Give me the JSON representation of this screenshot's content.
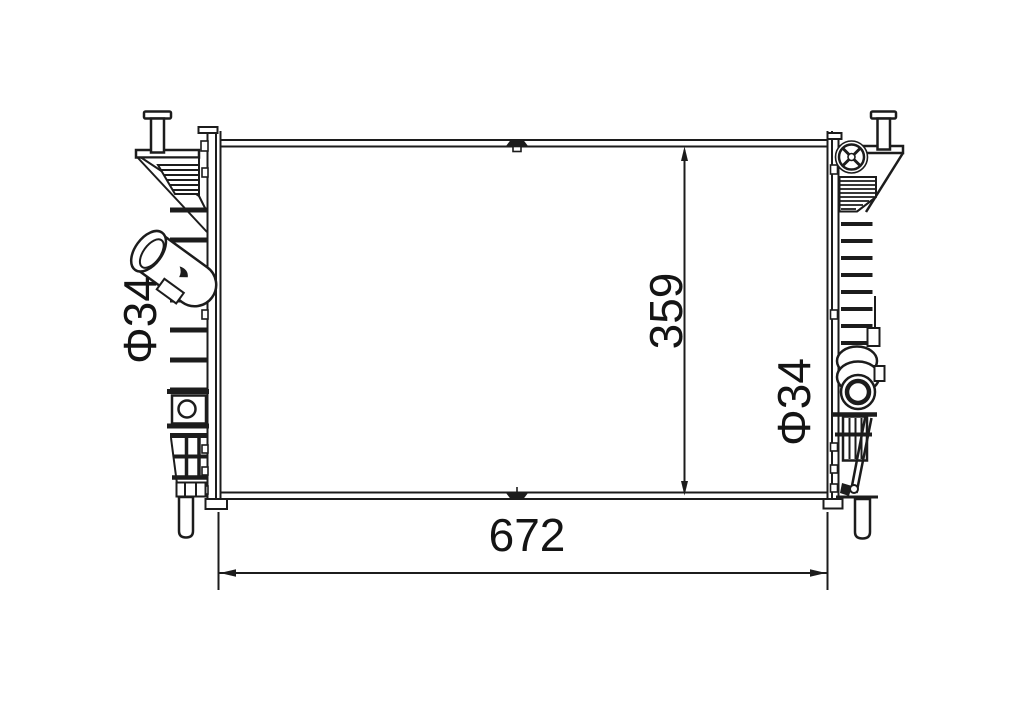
{
  "drawing": {
    "background_color": "#ffffff",
    "line_color": "#1c1c1c",
    "labels": {
      "width": "672",
      "height": "359",
      "inlet_diameter": "Φ34",
      "outlet_diameter": "Φ34"
    }
  }
}
